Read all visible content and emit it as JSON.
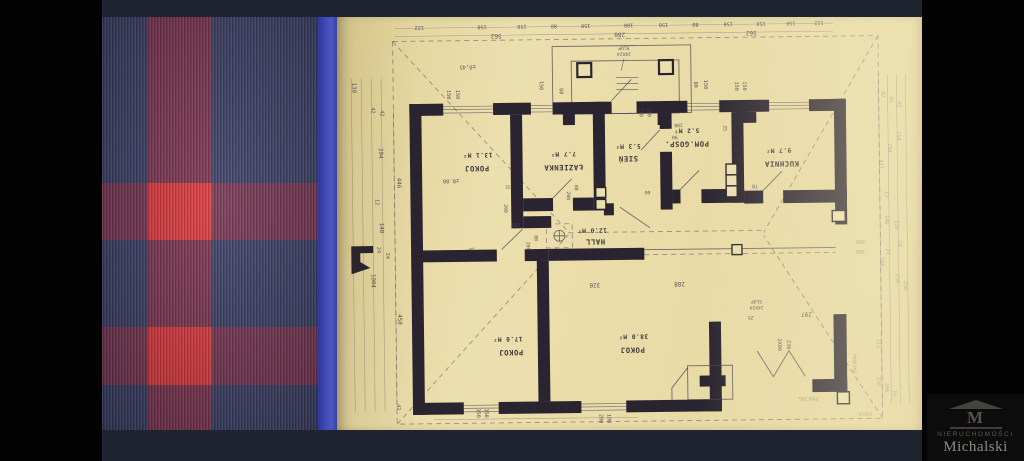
{
  "window": {
    "bg": "#020202",
    "frame_bg": "#1f2430"
  },
  "fabric": {
    "base": "#3d4166",
    "band": "#7e3650",
    "accent": "#dd3a3e",
    "edge": "#414bb5"
  },
  "paper": {
    "bg": "#ecdfae",
    "ink": "#29242f",
    "line": "#474253",
    "faint": "#8d8577"
  },
  "watermark": {
    "logo_letter": "M",
    "line1": "NIERUCHOMOŚCI",
    "line2": "Michalski"
  },
  "plan": {
    "orientation": "rotated-180",
    "rooms": [
      {
        "name": "POKOJ",
        "area": "13.1 M²",
        "nx": 141,
        "ny": 147,
        "ax": 142,
        "ay": 134
      },
      {
        "name": "ŁAZIENKA",
        "area": "7.7 M²",
        "nx": 228,
        "ny": 147,
        "ax": 228,
        "ay": 134
      },
      {
        "name": "SIEŃ",
        "area": "5.3 M²",
        "nx": 293,
        "ny": 139,
        "ax": 293,
        "ay": 127
      },
      {
        "name": "POM.GOSP.",
        "area": "5.2 M²",
        "nx": 352,
        "ny": 125,
        "ax": 352,
        "ay": 112
      },
      {
        "name": "KUCHNIA",
        "area": "9.7 M²",
        "nx": 447,
        "ny": 146,
        "ax": 444,
        "ay": 133
      },
      {
        "name": "HALL",
        "area": "12.0 M²",
        "nx": 259,
        "ny": 222,
        "ax": 256,
        "ay": 211
      },
      {
        "name": "POKOJ",
        "area": "17.0 M²",
        "nx": 173,
        "ny": 332,
        "ax": 170,
        "ay": 319
      },
      {
        "name": "POKOJ",
        "area": "38.0 M²",
        "nx": 295,
        "ny": 331,
        "ax": 296,
        "ay": 318
      }
    ],
    "dims": [
      [
        "122",
        85,
        6,
        180,
        5.2
      ],
      [
        "150",
        148,
        6,
        180,
        5.2
      ],
      [
        "150",
        188,
        6,
        180,
        5.2
      ],
      [
        "80",
        220,
        6,
        180,
        5.2
      ],
      [
        "150",
        252,
        6,
        180,
        5.2
      ],
      [
        "100",
        295,
        6,
        180,
        5.2
      ],
      [
        "150",
        330,
        6,
        180,
        5.2
      ],
      [
        "80",
        362,
        6,
        180,
        5.2
      ],
      [
        "150",
        395,
        6,
        180,
        5.2
      ],
      [
        "150",
        428,
        6,
        180,
        5.2
      ],
      [
        "150",
        458,
        6,
        180,
        5.2
      ],
      [
        "122",
        486,
        6,
        180,
        5.2
      ],
      [
        "562",
        162,
        15,
        180,
        6
      ],
      [
        "280",
        286,
        15,
        180,
        6
      ],
      [
        "562",
        418,
        15,
        180,
        6
      ],
      [
        "±0,45",
        133,
        46,
        180,
        5.5
      ],
      [
        "SLUP",
        290,
        29,
        180,
        4.6
      ],
      [
        "24X24",
        290,
        35,
        180,
        4.6
      ],
      [
        "230",
        305,
        95,
        90,
        5.2
      ],
      [
        "100",
        313,
        95,
        90,
        5.2
      ],
      [
        "150",
        112,
        75,
        90,
        5.2
      ],
      [
        "150",
        121,
        75,
        90,
        5.2
      ],
      [
        "150",
        205,
        67,
        90,
        5.2
      ],
      [
        "60",
        225,
        73,
        90,
        5.2
      ],
      [
        "80",
        360,
        68,
        90,
        5.2
      ],
      [
        "150",
        370,
        68,
        90,
        5.2
      ],
      [
        "150",
        401,
        70,
        90,
        5.2
      ],
      [
        "150",
        409,
        70,
        90,
        5.2
      ],
      [
        "130",
        17,
        67,
        90,
        5.8
      ],
      [
        "42",
        36,
        90,
        90,
        5.2
      ],
      [
        "42",
        45,
        93,
        90,
        5.2
      ],
      [
        "294",
        43,
        133,
        90,
        5.8
      ],
      [
        "446",
        61,
        163,
        90,
        5.8
      ],
      [
        "12",
        39,
        182,
        90,
        5.2
      ],
      [
        "140",
        43,
        208,
        90,
        5.8
      ],
      [
        "24",
        40,
        230,
        90,
        5.2
      ],
      [
        "24",
        49,
        236,
        90,
        5.2
      ],
      [
        "1004",
        34,
        261,
        90,
        5.8
      ],
      [
        "450",
        60,
        300,
        90,
        5.8
      ],
      [
        "42",
        58,
        388,
        90,
        5.2
      ],
      [
        "±0.00",
        115,
        160,
        180,
        5.5
      ],
      [
        "32",
        172,
        167,
        180,
        4.6
      ],
      [
        "200",
        168,
        190,
        90,
        4.8
      ],
      [
        "200",
        180,
        205,
        180,
        4.8
      ],
      [
        "200",
        190,
        228,
        90,
        4.8
      ],
      [
        "80",
        198,
        220,
        90,
        4.8
      ],
      [
        "10",
        135,
        229,
        180,
        4.6
      ],
      [
        "200",
        231,
        178,
        90,
        4.8
      ],
      [
        "80",
        239,
        170,
        90,
        4.8
      ],
      [
        "200",
        344,
        107,
        180,
        4.8
      ],
      [
        "90",
        340,
        119,
        180,
        4.8
      ],
      [
        "60",
        312,
        174,
        180,
        4.8
      ],
      [
        "25",
        389,
        112,
        90,
        4.8
      ],
      [
        "70",
        420,
        169,
        180,
        5.2
      ],
      [
        "320",
        258,
        266,
        180,
        6
      ],
      [
        "288",
        343,
        266,
        180,
        6
      ],
      [
        "297",
        470,
        298,
        180,
        6
      ],
      [
        "25",
        414,
        301,
        180,
        4.8
      ],
      [
        "SLUP",
        420,
        285,
        180,
        4.6
      ],
      [
        "24X24",
        420,
        291,
        180,
        4.6
      ],
      [
        "2X90",
        441,
        330,
        90,
        5.2
      ],
      [
        "230",
        450,
        330,
        90,
        5.2
      ],
      [
        "150",
        138,
        395,
        90,
        5.2
      ],
      [
        "150",
        146,
        395,
        90,
        5.2
      ],
      [
        "200",
        261,
        402,
        90,
        5.2
      ],
      [
        "180",
        269,
        402,
        90,
        5.2
      ],
      [
        "42",
        548,
        80,
        90,
        5.2,
        1
      ],
      [
        "42",
        556,
        85,
        90,
        5.2,
        1
      ],
      [
        "42",
        564,
        90,
        90,
        5.2,
        1
      ],
      [
        "250",
        563,
        122,
        90,
        5.2,
        1
      ],
      [
        "294",
        554,
        134,
        90,
        5.2,
        1
      ],
      [
        "412",
        545,
        150,
        90,
        5.2,
        1
      ],
      [
        "12",
        550,
        180,
        90,
        5.2,
        1
      ],
      [
        "140",
        550,
        206,
        90,
        5.2,
        1
      ],
      [
        "120",
        560,
        211,
        90,
        5.2,
        1
      ],
      [
        "24",
        563,
        230,
        90,
        5.2,
        1
      ],
      [
        "24",
        551,
        238,
        90,
        5.2,
        1
      ],
      [
        "100",
        545,
        248,
        90,
        5.2,
        1
      ],
      [
        "200",
        525,
        226,
        180,
        5.2,
        1
      ],
      [
        "180",
        525,
        236,
        180,
        5.2,
        1
      ],
      [
        "250",
        560,
        265,
        90,
        5.2,
        1
      ],
      [
        "250",
        568,
        272,
        90,
        5.2,
        1
      ],
      [
        "212",
        540,
        330,
        90,
        5.2,
        1
      ],
      [
        "158",
        540,
        368,
        90,
        5.2,
        1
      ],
      [
        "200",
        548,
        374,
        90,
        5.2,
        1
      ],
      [
        "24",
        556,
        380,
        90,
        5.2,
        1
      ],
      [
        "24X24",
        528,
        399,
        180,
        4.6,
        1
      ],
      [
        "PODCIAG",
        516,
        350,
        90,
        4.6,
        1
      ],
      [
        "PODCIAG",
        471,
        383,
        180,
        4.6,
        1
      ]
    ]
  }
}
